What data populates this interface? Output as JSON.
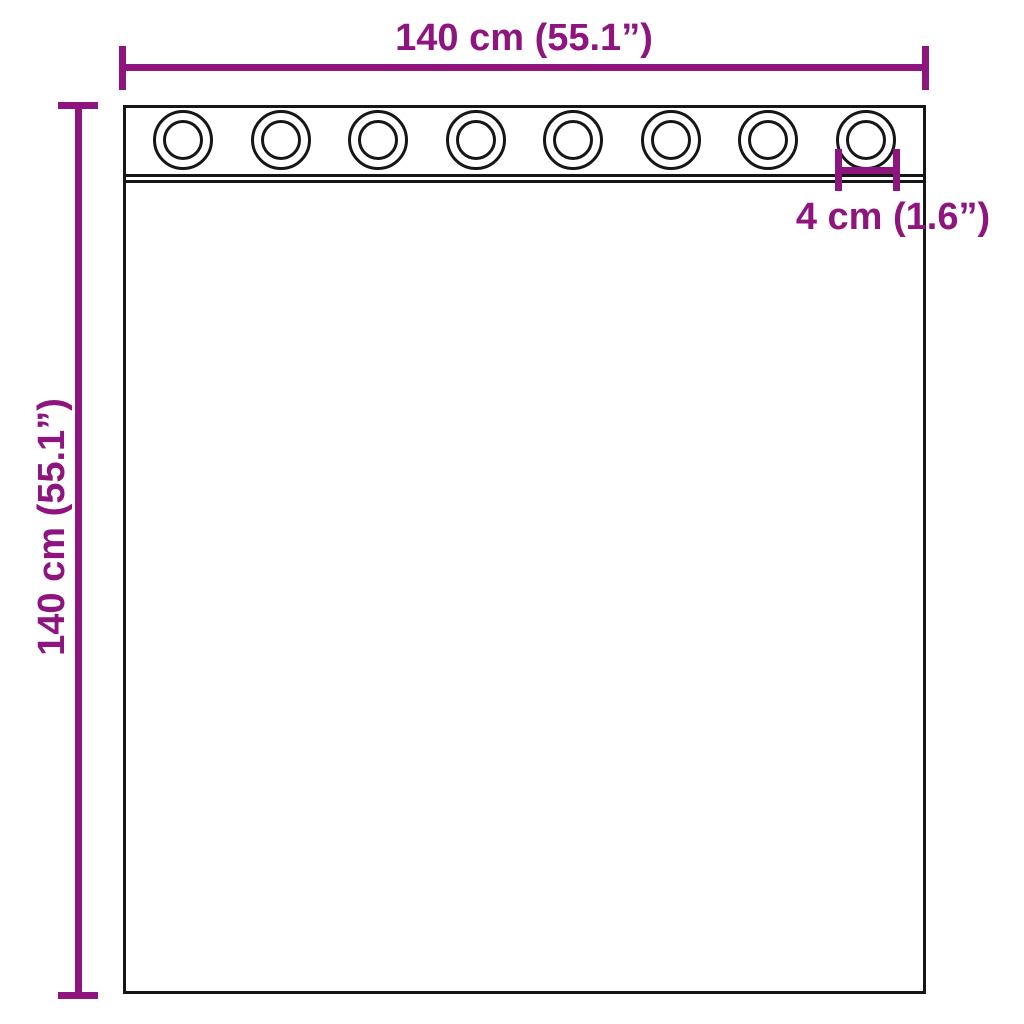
{
  "diagram": {
    "type": "product-dimension-diagram",
    "subject": "curtain with grommets",
    "width_label": "140 cm (55.1”)",
    "height_label": "140 cm (55.1”)",
    "grommet_diameter_label": "4 cm (1.6”)",
    "grommet_count": 8,
    "colors": {
      "dimension": "#8E157E",
      "outline": "#161616",
      "background": "#ffffff"
    }
  }
}
